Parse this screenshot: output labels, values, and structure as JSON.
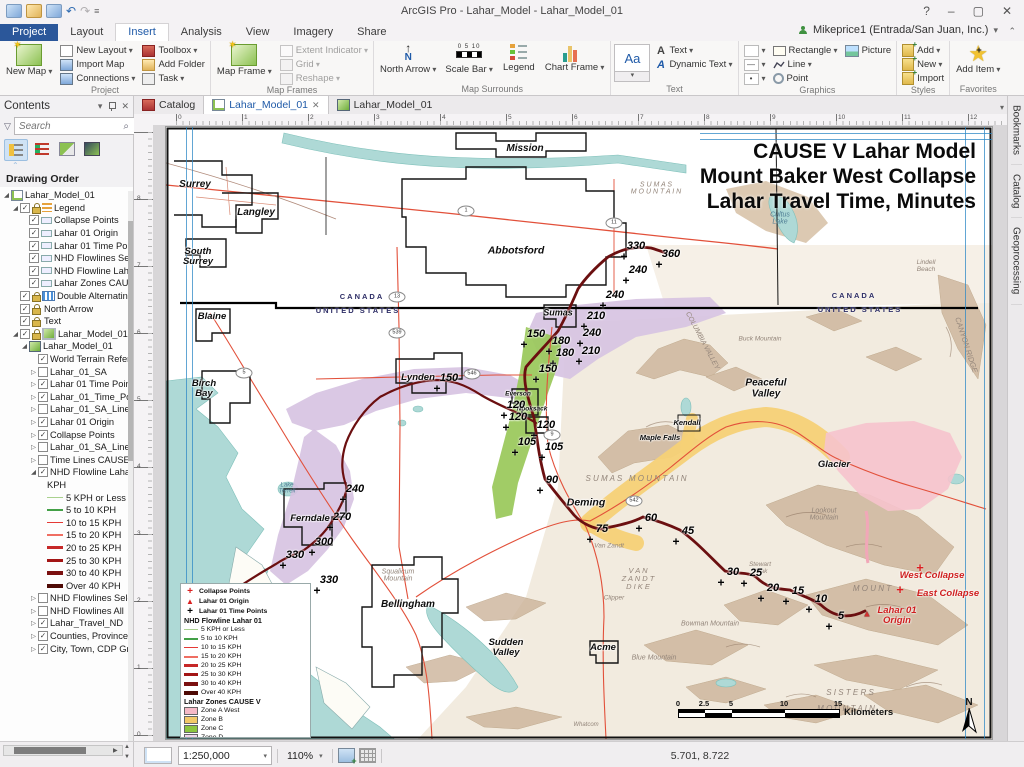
{
  "window": {
    "title": "ArcGIS Pro - Lahar_Model - Lahar_Model_01",
    "help_icon": "?",
    "user": "Mikeprice1 (Entrada/San Juan, Inc.)"
  },
  "ribbon": {
    "tabs": [
      "Project",
      "Layout",
      "Insert",
      "Analysis",
      "View",
      "Imagery",
      "Share"
    ],
    "active_tab": "Insert",
    "project": {
      "label": "Project",
      "new_map": "New Map",
      "new_layout": "New Layout",
      "import_map": "Import Map",
      "connections": "Connections",
      "toolbox": "Toolbox",
      "add_folder": "Add Folder",
      "task": "Task"
    },
    "map_frames": {
      "label": "Map Frames",
      "map_frame": "Map Frame",
      "extent_indicator": "Extent Indicator",
      "grid": "Grid",
      "reshape": "Reshape"
    },
    "map_surrounds": {
      "label": "Map Surrounds",
      "north_arrow": "North Arrow",
      "scale_bar": "Scale Bar",
      "legend": "Legend",
      "chart_frame": "Chart Frame"
    },
    "text": {
      "label": "Text",
      "gallery": "Aa",
      "text_btn": "Text",
      "dynamic_text": "Dynamic Text"
    },
    "graphics": {
      "label": "Graphics",
      "rectangle": "Rectangle",
      "picture": "Picture",
      "line": "Line",
      "point": "Point"
    },
    "styles": {
      "label": "Styles",
      "add": "Add",
      "new": "New",
      "import": "Import"
    },
    "favorites": {
      "label": "Favorites",
      "add_item": "Add Item"
    }
  },
  "doc_tabs": [
    {
      "label": "Catalog"
    },
    {
      "label": "Lahar_Model_01"
    },
    {
      "label": "Lahar_Model_01"
    }
  ],
  "right_tabs": [
    "Bookmarks",
    "Catalog",
    "Geoprocessing"
  ],
  "contents": {
    "title": "Contents",
    "search_placeholder": "Search",
    "heading": "Drawing Order",
    "tree": [
      {
        "i": 0,
        "e": "o",
        "ic": "layout",
        "t": "Lahar_Model_01"
      },
      {
        "i": 1,
        "e": "o",
        "k": true,
        "l": true,
        "ic": "legend",
        "t": "Legend"
      },
      {
        "i": 2,
        "k": true,
        "ic": "patch",
        "t": "Collapse Points"
      },
      {
        "i": 2,
        "k": true,
        "ic": "patch",
        "t": "Lahar 01 Origin"
      },
      {
        "i": 2,
        "k": true,
        "ic": "patch",
        "t": "Lahar 01 Time Poir"
      },
      {
        "i": 2,
        "k": true,
        "ic": "patch",
        "t": "NHD Flowlines Sele"
      },
      {
        "i": 2,
        "k": true,
        "ic": "patch",
        "t": "NHD Flowline Laha"
      },
      {
        "i": 2,
        "k": true,
        "ic": "patch",
        "t": "Lahar Zones CAUSE"
      },
      {
        "i": 1,
        "k": true,
        "l": true,
        "ic": "grid",
        "t": "Double Alternating"
      },
      {
        "i": 1,
        "k": true,
        "l": true,
        "ic": "north",
        "t": "North Arrow"
      },
      {
        "i": 1,
        "k": true,
        "l": true,
        "ic": "textA",
        "t": "Text"
      },
      {
        "i": 1,
        "e": "o",
        "k": true,
        "l": true,
        "ic": "frame",
        "t": "Lahar_Model_01 I"
      },
      {
        "i": 2,
        "e": "o",
        "ic": "map",
        "t": "Lahar_Model_01"
      },
      {
        "i": 3,
        "k": true,
        "t": "World Terrain Refere"
      },
      {
        "i": 3,
        "e": "c",
        "k": false,
        "t": "Lahar_01_SA"
      },
      {
        "i": 3,
        "e": "c",
        "k": true,
        "t": "Lahar 01 Time Point"
      },
      {
        "i": 3,
        "e": "c",
        "k": true,
        "t": "Lahar_01_Time_Point"
      },
      {
        "i": 3,
        "e": "c",
        "k": false,
        "t": "Lahar_01_SA_Lines_X"
      },
      {
        "i": 3,
        "e": "c",
        "k": true,
        "t": "Lahar 01 Origin"
      },
      {
        "i": 3,
        "e": "c",
        "k": true,
        "t": "Collapse Points"
      },
      {
        "i": 3,
        "e": "c",
        "k": false,
        "t": "Lahar_01_SA_Lines"
      },
      {
        "i": 3,
        "e": "c",
        "k": false,
        "t": "Time Lines CAUSE V"
      },
      {
        "i": 3,
        "e": "o",
        "k": true,
        "t": "NHD Flowline Lahar"
      },
      {
        "i": 4,
        "t": "KPH"
      },
      {
        "i": 4,
        "sw": "#a9d18e",
        "w": 1,
        "t": "5 KPH or Less"
      },
      {
        "i": 4,
        "sw": "#43a047",
        "w": 2,
        "t": "5 to 10 KPH"
      },
      {
        "i": 4,
        "sw": "#e53935",
        "w": 1,
        "t": "10 to 15 KPH"
      },
      {
        "i": 4,
        "sw": "#ef6e62",
        "w": 2,
        "t": "15 to 20 KPH"
      },
      {
        "i": 4,
        "sw": "#c62828",
        "w": 3,
        "t": "20 to 25 KPH"
      },
      {
        "i": 4,
        "sw": "#a31515",
        "w": 3,
        "t": "25 to 30 KPH"
      },
      {
        "i": 4,
        "sw": "#7b1010",
        "w": 4,
        "t": "30 to 40 KPH"
      },
      {
        "i": 4,
        "sw": "#4e0a05",
        "w": 4,
        "t": "Over 40 KPH"
      },
      {
        "i": 3,
        "e": "c",
        "k": false,
        "t": "NHD Flowlines Selec"
      },
      {
        "i": 3,
        "e": "c",
        "k": false,
        "t": "NHD Flowlines All"
      },
      {
        "i": 3,
        "e": "c",
        "k": true,
        "t": "Lahar_Travel_ND"
      },
      {
        "i": 3,
        "e": "c",
        "k": true,
        "t": "Counties, Province"
      },
      {
        "i": 3,
        "e": "c",
        "k": true,
        "t": "City, Town, CDP Gro"
      }
    ]
  },
  "rulers": {
    "h": [
      "0",
      "1",
      "2",
      "3",
      "4",
      "5",
      "6",
      "7",
      "8",
      "9",
      "10",
      "11",
      "12"
    ],
    "v": [
      "8",
      "7",
      "6",
      "5",
      "4",
      "3",
      "2",
      "1",
      "0"
    ]
  },
  "status": {
    "scale": "1:250,000",
    "zoom": "110%",
    "coords": "5.701, 8.722"
  },
  "map": {
    "title_lines": [
      "CAUSE V Lahar Model",
      "Mount Baker West Collapse",
      "Lahar Travel Time, Minutes"
    ],
    "border_labels": [
      {
        "t": "CANADA",
        "x": 196,
        "y": 170
      },
      {
        "t": "UNITED STATES",
        "x": 192,
        "y": 184
      },
      {
        "t": "CANADA",
        "x": 688,
        "y": 169
      },
      {
        "t": "UNITED STATES",
        "x": 694,
        "y": 183
      }
    ],
    "cities": [
      {
        "t": "Mission",
        "x": 359,
        "y": 22,
        "s": 10
      },
      {
        "t": "Surrey",
        "x": 29,
        "y": 58,
        "s": 10
      },
      {
        "t": "Langley",
        "x": 90,
        "y": 86,
        "s": 10
      },
      {
        "t": "South\nSurrey",
        "x": 32,
        "y": 130,
        "s": 9.5
      },
      {
        "t": "Abbotsford",
        "x": 350,
        "y": 124,
        "s": 10.5
      },
      {
        "t": "Blaine",
        "x": 46,
        "y": 190,
        "s": 9.5
      },
      {
        "t": "Birch\nBay",
        "x": 38,
        "y": 262,
        "s": 9.5
      },
      {
        "t": "Lynden",
        "x": 252,
        "y": 251,
        "s": 9.5
      },
      {
        "t": "Ferndale",
        "x": 144,
        "y": 392,
        "s": 9.5
      },
      {
        "t": "Bellingham",
        "x": 242,
        "y": 478,
        "s": 10
      },
      {
        "t": "Sudden\nValley",
        "x": 340,
        "y": 521,
        "s": 9.5
      },
      {
        "t": "Acme",
        "x": 437,
        "y": 521,
        "s": 9.5
      },
      {
        "t": "Deming",
        "x": 420,
        "y": 376,
        "s": 10.5
      },
      {
        "t": "Glacier",
        "x": 668,
        "y": 338,
        "s": 9.5
      },
      {
        "t": "Sumas",
        "x": 392,
        "y": 186,
        "s": 9
      },
      {
        "t": "Peaceful\nValley",
        "x": 600,
        "y": 262,
        "s": 10
      },
      {
        "t": "Kendall",
        "x": 521,
        "y": 296,
        "s": 7.5
      },
      {
        "t": "Maple Falls",
        "x": 494,
        "y": 311,
        "s": 7.5
      },
      {
        "t": "Nooksack",
        "x": 366,
        "y": 283,
        "s": 6.5
      },
      {
        "t": "Everson",
        "x": 352,
        "y": 268,
        "s": 6.5
      }
    ],
    "terrain_labels": [
      {
        "t": "S U M A S   M O U N T A I N",
        "x": 470,
        "y": 352,
        "s": 8
      },
      {
        "t": "Van Zandt",
        "x": 443,
        "y": 420,
        "s": 6.5
      },
      {
        "t": "V A N\nZ A N D T\nD I K E",
        "x": 472,
        "y": 452,
        "s": 7.5
      },
      {
        "t": "Clipper",
        "x": 448,
        "y": 472,
        "s": 6.5
      },
      {
        "t": "Stewart\nPeak",
        "x": 594,
        "y": 442,
        "s": 6.5
      },
      {
        "t": "Bowman Mountain",
        "x": 544,
        "y": 497,
        "s": 7
      },
      {
        "t": "Blue Mountain",
        "x": 488,
        "y": 531,
        "s": 7
      },
      {
        "t": "Lookout\nMountain",
        "x": 658,
        "y": 388,
        "s": 7
      },
      {
        "t": "Squalicum\nMountain",
        "x": 232,
        "y": 449,
        "s": 7
      },
      {
        "t": "Buck Mountain",
        "x": 594,
        "y": 213,
        "s": 6.5
      },
      {
        "t": "M O U N T",
        "x": 706,
        "y": 462,
        "s": 8
      },
      {
        "t": "S I S T E R S",
        "x": 684,
        "y": 566,
        "s": 8
      },
      {
        "t": "M O U N T A I N",
        "x": 680,
        "y": 582,
        "s": 8
      },
      {
        "t": "S U M A S\nM O U N T A I N",
        "x": 490,
        "y": 62,
        "s": 7
      },
      {
        "t": "CANYON RIDGE",
        "x": 800,
        "y": 218,
        "s": 7.5,
        "r": 72
      },
      {
        "t": "COLUMBIA VALLEY",
        "x": 536,
        "y": 214,
        "s": 7,
        "r": 62
      },
      {
        "t": "Lindell\nBeach",
        "x": 760,
        "y": 140,
        "s": 6.5
      },
      {
        "t": "Whatcom",
        "x": 420,
        "y": 598,
        "s": 6
      }
    ],
    "water_labels": [
      {
        "t": "Cultus\nLake",
        "x": 614,
        "y": 92,
        "s": 7
      },
      {
        "t": "Lake\nTerrell",
        "x": 121,
        "y": 362,
        "s": 6
      }
    ],
    "red_labels": [
      {
        "t": "West Collapse",
        "x": 766,
        "y": 449
      },
      {
        "t": "East Collapse",
        "x": 782,
        "y": 467
      },
      {
        "t": "Lahar 01\nOrigin",
        "x": 731,
        "y": 489
      }
    ],
    "collapse_crosses": [
      {
        "x": 754,
        "y": 441
      },
      {
        "x": 734,
        "y": 463
      }
    ],
    "origin_triangle": {
      "x": 701,
      "y": 487
    },
    "time_points": [
      {
        "v": "330",
        "x": 470,
        "y": 120
      },
      {
        "v": "360",
        "x": 505,
        "y": 128
      },
      {
        "v": "240",
        "x": 472,
        "y": 144
      },
      {
        "v": "240",
        "x": 449,
        "y": 169
      },
      {
        "v": "210",
        "x": 430,
        "y": 190
      },
      {
        "v": "240",
        "x": 426,
        "y": 207
      },
      {
        "v": "150",
        "x": 370,
        "y": 208
      },
      {
        "v": "180",
        "x": 395,
        "y": 215
      },
      {
        "v": "210",
        "x": 425,
        "y": 225
      },
      {
        "v": "180",
        "x": 399,
        "y": 227
      },
      {
        "v": "150",
        "x": 382,
        "y": 243
      },
      {
        "v": "150",
        "x": 283,
        "y": 252
      },
      {
        "v": "120",
        "x": 350,
        "y": 279
      },
      {
        "v": "120",
        "x": 352,
        "y": 291
      },
      {
        "v": "120",
        "x": 380,
        "y": 299
      },
      {
        "v": "105",
        "x": 361,
        "y": 316
      },
      {
        "v": "105",
        "x": 388,
        "y": 321
      },
      {
        "v": "90",
        "x": 386,
        "y": 354
      },
      {
        "v": "240",
        "x": 189,
        "y": 363
      },
      {
        "v": "270",
        "x": 176,
        "y": 391
      },
      {
        "v": "300",
        "x": 158,
        "y": 416
      },
      {
        "v": "330",
        "x": 129,
        "y": 429
      },
      {
        "v": "330",
        "x": 163,
        "y": 454
      },
      {
        "v": "75",
        "x": 436,
        "y": 403
      },
      {
        "v": "60",
        "x": 485,
        "y": 392
      },
      {
        "v": "45",
        "x": 522,
        "y": 405
      },
      {
        "v": "30",
        "x": 567,
        "y": 446
      },
      {
        "v": "25",
        "x": 590,
        "y": 447
      },
      {
        "v": "20",
        "x": 607,
        "y": 462
      },
      {
        "v": "15",
        "x": 632,
        "y": 465
      },
      {
        "v": "10",
        "x": 655,
        "y": 473
      },
      {
        "v": "5",
        "x": 675,
        "y": 490
      }
    ],
    "shields": [
      {
        "n": "1",
        "x": 300,
        "y": 84
      },
      {
        "n": "13",
        "x": 231,
        "y": 170
      },
      {
        "n": "539",
        "x": 231,
        "y": 206
      },
      {
        "n": "5",
        "x": 78,
        "y": 246
      },
      {
        "n": "546",
        "x": 306,
        "y": 247
      },
      {
        "n": "9",
        "x": 386,
        "y": 308
      },
      {
        "n": "542",
        "x": 468,
        "y": 374
      },
      {
        "n": "11",
        "x": 448,
        "y": 96
      }
    ],
    "legend": {
      "points": [
        {
          "icon": "cross-red",
          "t": "Collapse Points"
        },
        {
          "icon": "tri-red",
          "t": "Lahar 01 Origin"
        },
        {
          "icon": "cross-black",
          "t": "Lahar 01 Time Points"
        }
      ],
      "flow_title": "NHD Flowline Lahar 01",
      "kph": [
        {
          "c": "#a9d18e",
          "w": 1,
          "t": "5 KPH or Less"
        },
        {
          "c": "#43a047",
          "w": 2,
          "t": "5 to 10 KPH"
        },
        {
          "c": "#e53935",
          "w": 1,
          "t": "10 to 15 KPH"
        },
        {
          "c": "#ef6e62",
          "w": 2,
          "t": "15 to 20 KPH"
        },
        {
          "c": "#c62828",
          "w": 3,
          "t": "20 to 25 KPH"
        },
        {
          "c": "#a31515",
          "w": 3,
          "t": "25 to 30 KPH"
        },
        {
          "c": "#7b1010",
          "w": 4,
          "t": "30 to 40 KPH"
        },
        {
          "c": "#4e0a05",
          "w": 4,
          "t": "Over 40 KPH"
        }
      ],
      "zones_title": "Lahar Zones CAUSE V",
      "zones": [
        {
          "c": "#f6b9c6",
          "t": "Zone A West"
        },
        {
          "c": "#f3c968",
          "t": "Zone B"
        },
        {
          "c": "#8dc63f",
          "t": "Zone C"
        },
        {
          "c": "#f0d3ea",
          "t": "Zone D"
        }
      ]
    },
    "scalebar": {
      "ticks": [
        "0",
        "2.5",
        "5",
        "10",
        "15"
      ],
      "unit": "Kilometers"
    },
    "north_label": "N"
  }
}
